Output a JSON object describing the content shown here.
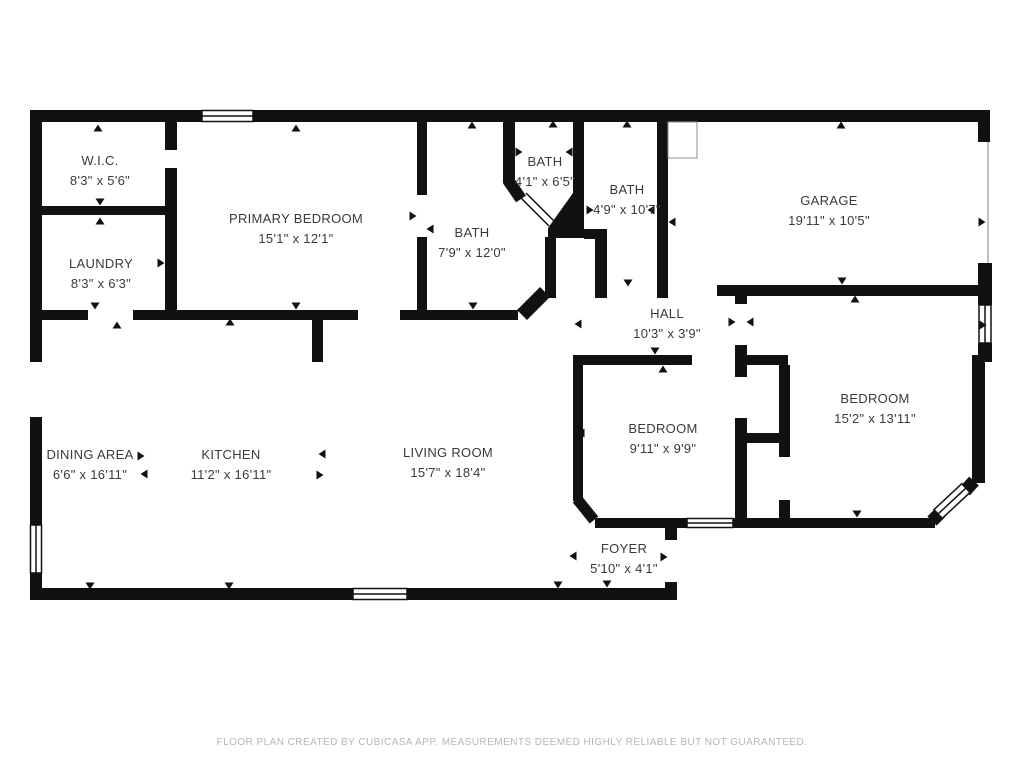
{
  "page": {
    "background": "#ffffff",
    "wall_color": "#111111",
    "label_color": "#3a3a3a",
    "footer_color": "#b6b6b6"
  },
  "rooms": [
    {
      "id": "wic",
      "name": "W.I.C.",
      "dims": "8'3\" x 5'6\"",
      "cx": 100,
      "cy": 171
    },
    {
      "id": "laundry",
      "name": "LAUNDRY",
      "dims": "8'3\" x 6'3\"",
      "cx": 101,
      "cy": 274
    },
    {
      "id": "primary-bedroom",
      "name": "PRIMARY BEDROOM",
      "dims": "15'1\" x 12'1\"",
      "cx": 296,
      "cy": 229
    },
    {
      "id": "bath-small",
      "name": "BATH",
      "dims": "4'1\" x 6'5\"",
      "cx": 545,
      "cy": 172
    },
    {
      "id": "bath-mid",
      "name": "BATH",
      "dims": "4'9\" x 10'7\"",
      "cx": 627,
      "cy": 200
    },
    {
      "id": "bath-large",
      "name": "BATH",
      "dims": "7'9\" x 12'0\"",
      "cx": 472,
      "cy": 243
    },
    {
      "id": "garage",
      "name": "GARAGE",
      "dims": "19'11\" x 10'5\"",
      "cx": 829,
      "cy": 211
    },
    {
      "id": "hall",
      "name": "HALL",
      "dims": "10'3\" x 3'9\"",
      "cx": 667,
      "cy": 324
    },
    {
      "id": "bedroom-left",
      "name": "BEDROOM",
      "dims": "9'11\" x 9'9\"",
      "cx": 663,
      "cy": 439
    },
    {
      "id": "bedroom-right",
      "name": "BEDROOM",
      "dims": "15'2\" x 13'11\"",
      "cx": 875,
      "cy": 409
    },
    {
      "id": "foyer",
      "name": "FOYER",
      "dims": "5'10\" x 4'1\"",
      "cx": 624,
      "cy": 559
    },
    {
      "id": "dining-area",
      "name": "DINING AREA",
      "dims": "6'6\" x 16'11\"",
      "cx": 90,
      "cy": 465
    },
    {
      "id": "kitchen",
      "name": "KITCHEN",
      "dims": "11'2\" x 16'11\"",
      "cx": 231,
      "cy": 465
    },
    {
      "id": "living-room",
      "name": "LIVING ROOM",
      "dims": "15'7\" x 18'4\"",
      "cx": 448,
      "cy": 463
    }
  ],
  "arrows": [
    {
      "x": 98,
      "y": 128,
      "d": "up"
    },
    {
      "x": 37,
      "y": 162,
      "d": "left"
    },
    {
      "x": 100,
      "y": 202,
      "d": "down"
    },
    {
      "x": 100,
      "y": 221,
      "d": "up"
    },
    {
      "x": 35,
      "y": 263,
      "d": "left"
    },
    {
      "x": 161,
      "y": 263,
      "d": "right"
    },
    {
      "x": 296,
      "y": 128,
      "d": "up"
    },
    {
      "x": 296,
      "y": 306,
      "d": "down"
    },
    {
      "x": 95,
      "y": 306,
      "d": "down"
    },
    {
      "x": 117,
      "y": 325,
      "d": "up"
    },
    {
      "x": 413,
      "y": 216,
      "d": "right"
    },
    {
      "x": 430,
      "y": 229,
      "d": "left"
    },
    {
      "x": 472,
      "y": 125,
      "d": "up"
    },
    {
      "x": 473,
      "y": 306,
      "d": "down"
    },
    {
      "x": 553,
      "y": 124,
      "d": "up"
    },
    {
      "x": 519,
      "y": 152,
      "d": "right"
    },
    {
      "x": 569,
      "y": 152,
      "d": "left"
    },
    {
      "x": 627,
      "y": 124,
      "d": "up"
    },
    {
      "x": 590,
      "y": 210,
      "d": "right"
    },
    {
      "x": 651,
      "y": 210,
      "d": "left"
    },
    {
      "x": 628,
      "y": 283,
      "d": "down"
    },
    {
      "x": 841,
      "y": 125,
      "d": "up"
    },
    {
      "x": 982,
      "y": 222,
      "d": "right"
    },
    {
      "x": 842,
      "y": 281,
      "d": "down"
    },
    {
      "x": 672,
      "y": 222,
      "d": "left"
    },
    {
      "x": 578,
      "y": 324,
      "d": "left"
    },
    {
      "x": 732,
      "y": 322,
      "d": "right"
    },
    {
      "x": 750,
      "y": 322,
      "d": "left"
    },
    {
      "x": 655,
      "y": 351,
      "d": "down"
    },
    {
      "x": 663,
      "y": 369,
      "d": "up"
    },
    {
      "x": 581,
      "y": 433,
      "d": "left"
    },
    {
      "x": 605,
      "y": 524,
      "d": "down"
    },
    {
      "x": 855,
      "y": 299,
      "d": "up"
    },
    {
      "x": 857,
      "y": 514,
      "d": "down"
    },
    {
      "x": 983,
      "y": 325,
      "d": "right"
    },
    {
      "x": 573,
      "y": 556,
      "d": "left"
    },
    {
      "x": 664,
      "y": 557,
      "d": "right"
    },
    {
      "x": 607,
      "y": 584,
      "d": "down"
    },
    {
      "x": 38,
      "y": 455,
      "d": "left"
    },
    {
      "x": 141,
      "y": 456,
      "d": "right"
    },
    {
      "x": 144,
      "y": 474,
      "d": "left"
    },
    {
      "x": 90,
      "y": 586,
      "d": "down"
    },
    {
      "x": 230,
      "y": 322,
      "d": "up"
    },
    {
      "x": 322,
      "y": 454,
      "d": "left"
    },
    {
      "x": 320,
      "y": 475,
      "d": "right"
    },
    {
      "x": 229,
      "y": 586,
      "d": "down"
    },
    {
      "x": 558,
      "y": 585,
      "d": "down"
    }
  ],
  "footer": {
    "text": "FLOOR PLAN CREATED BY CUBICASA APP. MEASUREMENTS DEEMED HIGHLY RELIABLE BUT NOT GUARANTEED."
  }
}
